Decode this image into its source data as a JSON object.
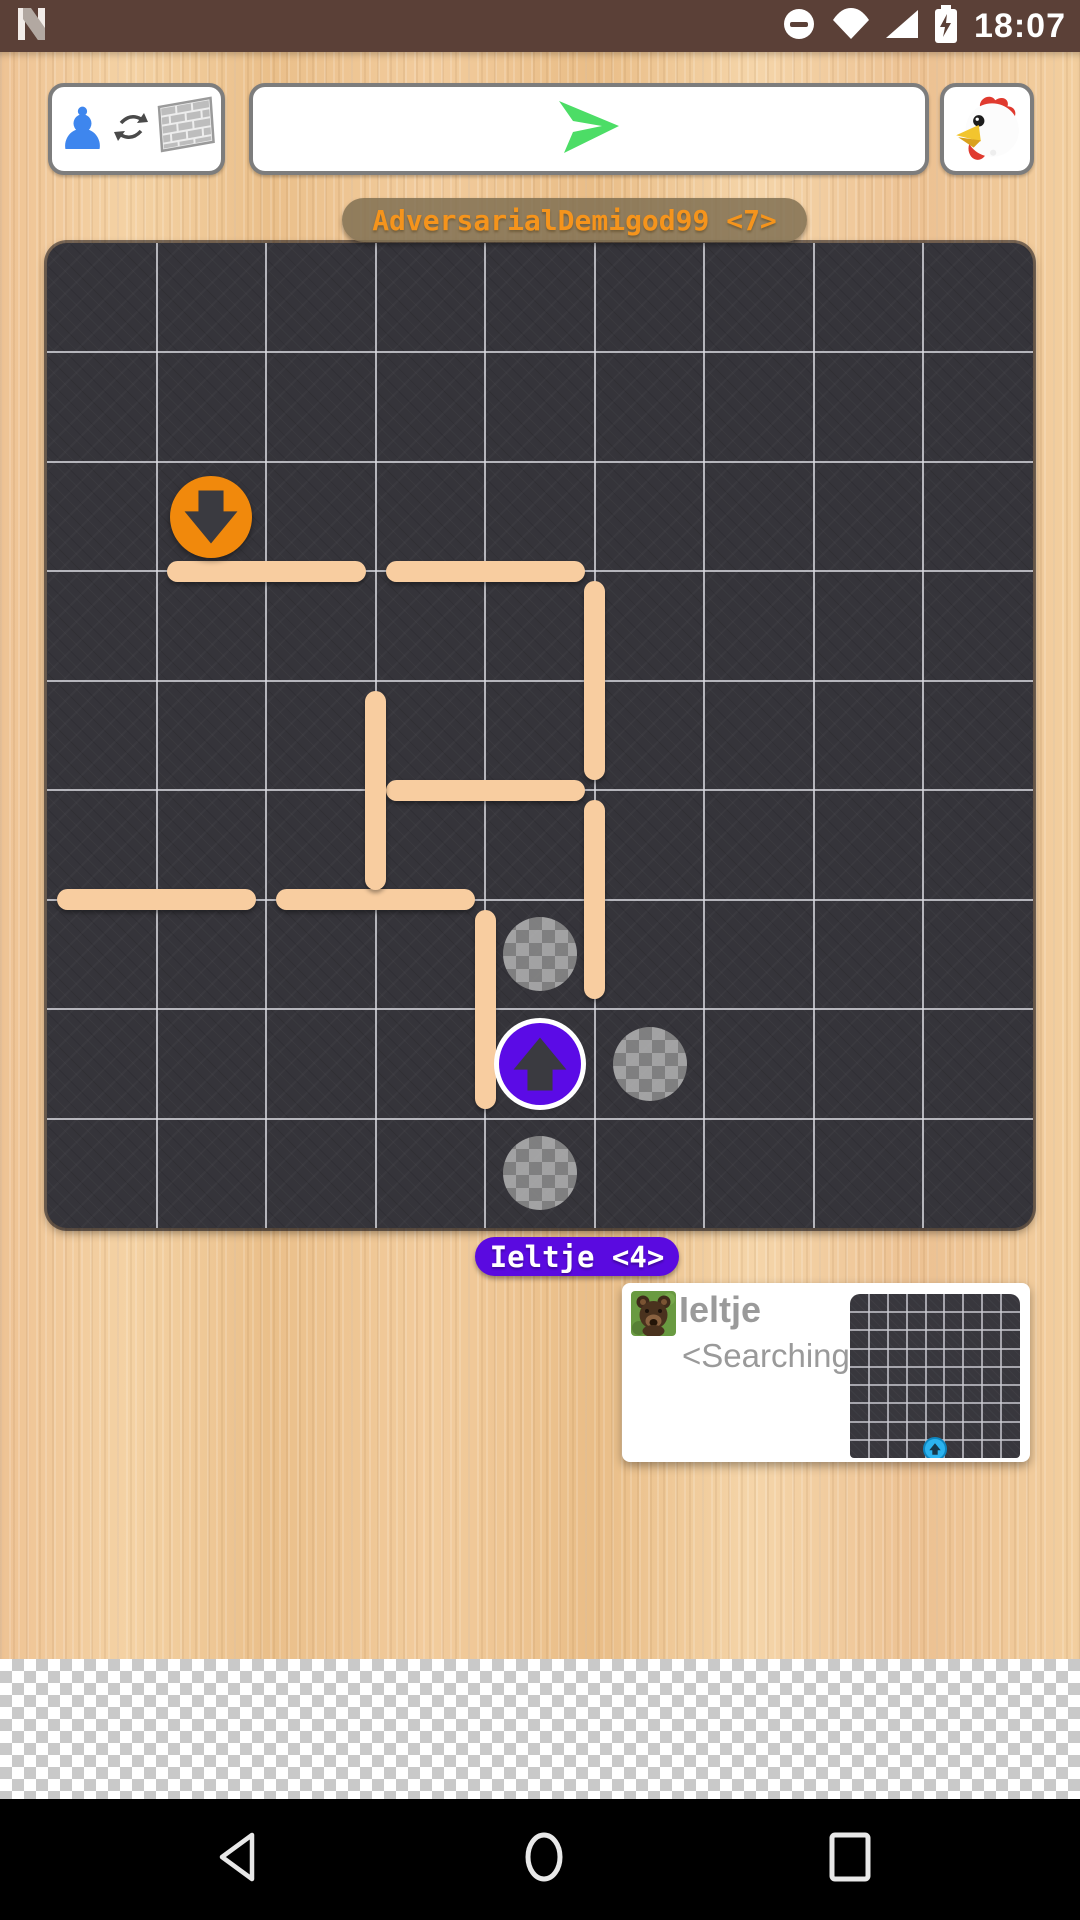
{
  "status_bar": {
    "time": "18:07",
    "bg_color": "#5b4037",
    "left_icon": "n-logo",
    "right_icons": [
      "do-not-disturb",
      "wifi",
      "cellular-signal",
      "battery-charging"
    ]
  },
  "toolbar": {
    "piece_toggle": {
      "icons": [
        "chess-pawn",
        "swap-arrows",
        "brick-wall"
      ],
      "pawn_glyph": "♟",
      "pawn_color": "#3e86ee"
    },
    "send": {
      "icon": "paper-plane",
      "color": "#4cdd66"
    },
    "chicken_button": {
      "icon": "chicken"
    }
  },
  "opponent_label": {
    "text": "AdversarialDemigod99 <7>",
    "text_color": "#f5941c",
    "bg_color": "rgba(128,112,82,0.85)"
  },
  "player_label": {
    "text": "Ieltje <4>",
    "text_color": "#ffffff",
    "bg_color": "#5a0ae0"
  },
  "board": {
    "grid_size": 9,
    "bg_color": "#35343a",
    "grid_line_color": "rgba(218,218,224,0.78)",
    "wall_color": "#f8cda0",
    "pawns": [
      {
        "name": "opponent-pawn",
        "col": 1,
        "row": 2,
        "direction": "down",
        "color": "#f1890c",
        "ring": false
      },
      {
        "name": "player-pawn",
        "col": 4,
        "row": 7,
        "direction": "up",
        "color": "#5b0be6",
        "ring": true
      }
    ],
    "move_hints": [
      {
        "col": 4,
        "row": 6
      },
      {
        "col": 5,
        "row": 7
      },
      {
        "col": 4,
        "row": 8
      }
    ],
    "walls": [
      {
        "orientation": "horizontal",
        "line": 3,
        "start": 1
      },
      {
        "orientation": "horizontal",
        "line": 3,
        "start": 3
      },
      {
        "orientation": "horizontal",
        "line": 5,
        "start": 3
      },
      {
        "orientation": "horizontal",
        "line": 6,
        "start": 0
      },
      {
        "orientation": "horizontal",
        "line": 6,
        "start": 2
      },
      {
        "orientation": "vertical",
        "line": 3,
        "start": 4
      },
      {
        "orientation": "vertical",
        "line": 5,
        "start": 3
      },
      {
        "orientation": "vertical",
        "line": 5,
        "start": 5
      },
      {
        "orientation": "vertical",
        "line": 4,
        "start": 6
      }
    ]
  },
  "opponent_card": {
    "name": "Ieltje",
    "status": "<Searching>",
    "avatar": "teddy-bear",
    "preview": {
      "grid_size": 9,
      "bg_color": "#38373d",
      "pawn": {
        "col": 4,
        "row": 8,
        "direction": "up",
        "color": "#2bb3ef"
      }
    }
  },
  "nav_bar": {
    "bg_color": "#000000",
    "icons": [
      "back",
      "home",
      "recents"
    ]
  }
}
